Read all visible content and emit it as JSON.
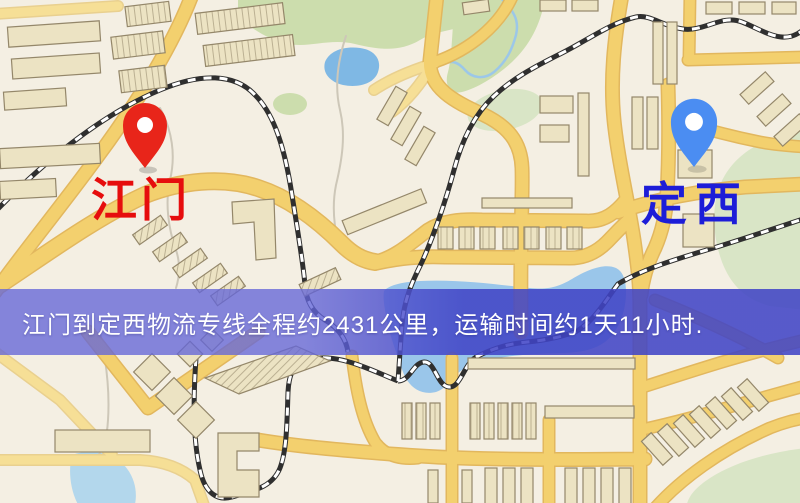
{
  "banner": {
    "text": "江门到定西物流专线全程约2431公里，运输时间约1天11小时."
  },
  "markers": {
    "origin": {
      "label": "江门"
    },
    "destination": {
      "label": "定西"
    }
  },
  "colors": {
    "map-bg": "#f4efe3",
    "road-fill": "#f3d06e",
    "road-casing": "#e2b75e",
    "road-minor": "#f6df96",
    "road-minor-casing": "#e9d08f",
    "rail-dark": "#2f2f2f",
    "rail-light": "#ffffff",
    "building-fill": "#ece3c3",
    "building-stroke": "#94876a",
    "green": "#ccddad",
    "green-light": "#d9e5c6",
    "water": "#7fb8e4",
    "water-mid": "#9ac6ea",
    "water-light": "#b3d7ec",
    "stream-blue": "#9cc7e8",
    "stream-gray": "#cdc7b8",
    "banner-left": "rgba(100,102,216,0.78)",
    "banner-right": "rgba(64,68,198,0.87)",
    "banner-text": "#ffffff",
    "origin-pin": "#e8251a",
    "origin-label": "#e60d0d",
    "destination-pin": "#4b8df2",
    "destination-label": "#1d1dd8",
    "pin-hole": "#ffffff"
  }
}
